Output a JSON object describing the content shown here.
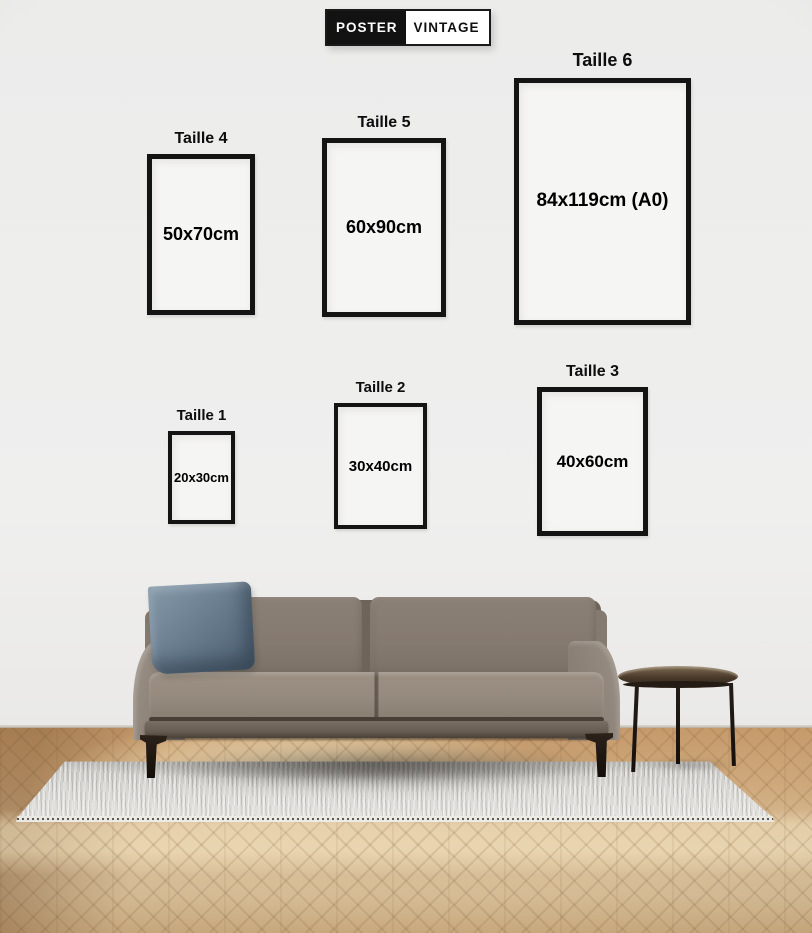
{
  "brand": {
    "logo_left": "POSTER",
    "logo_right": "VINTAGE"
  },
  "size_guide": {
    "frames": [
      {
        "label": "Taille 1",
        "size": "20x30cm"
      },
      {
        "label": "Taille 2",
        "size": "30x40cm"
      },
      {
        "label": "Taille 3",
        "size": "40x60cm"
      },
      {
        "label": "Taille 4",
        "size": "50x70cm"
      },
      {
        "label": "Taille 5",
        "size": "60x90cm"
      },
      {
        "label": "Taille 6",
        "size": "84x119cm (A0)"
      }
    ]
  },
  "colors": {
    "wall": "#ededec",
    "frame_border": "#141414",
    "frame_fill": "#f5f5f3",
    "text": "#0d0d0d",
    "sofa": "#8c8177",
    "pillow": "#64788a",
    "rug": "#d6d5d1",
    "floor_highlight": "#f4e7c4",
    "floor_base": "#cda577",
    "table": "#3f3226"
  }
}
